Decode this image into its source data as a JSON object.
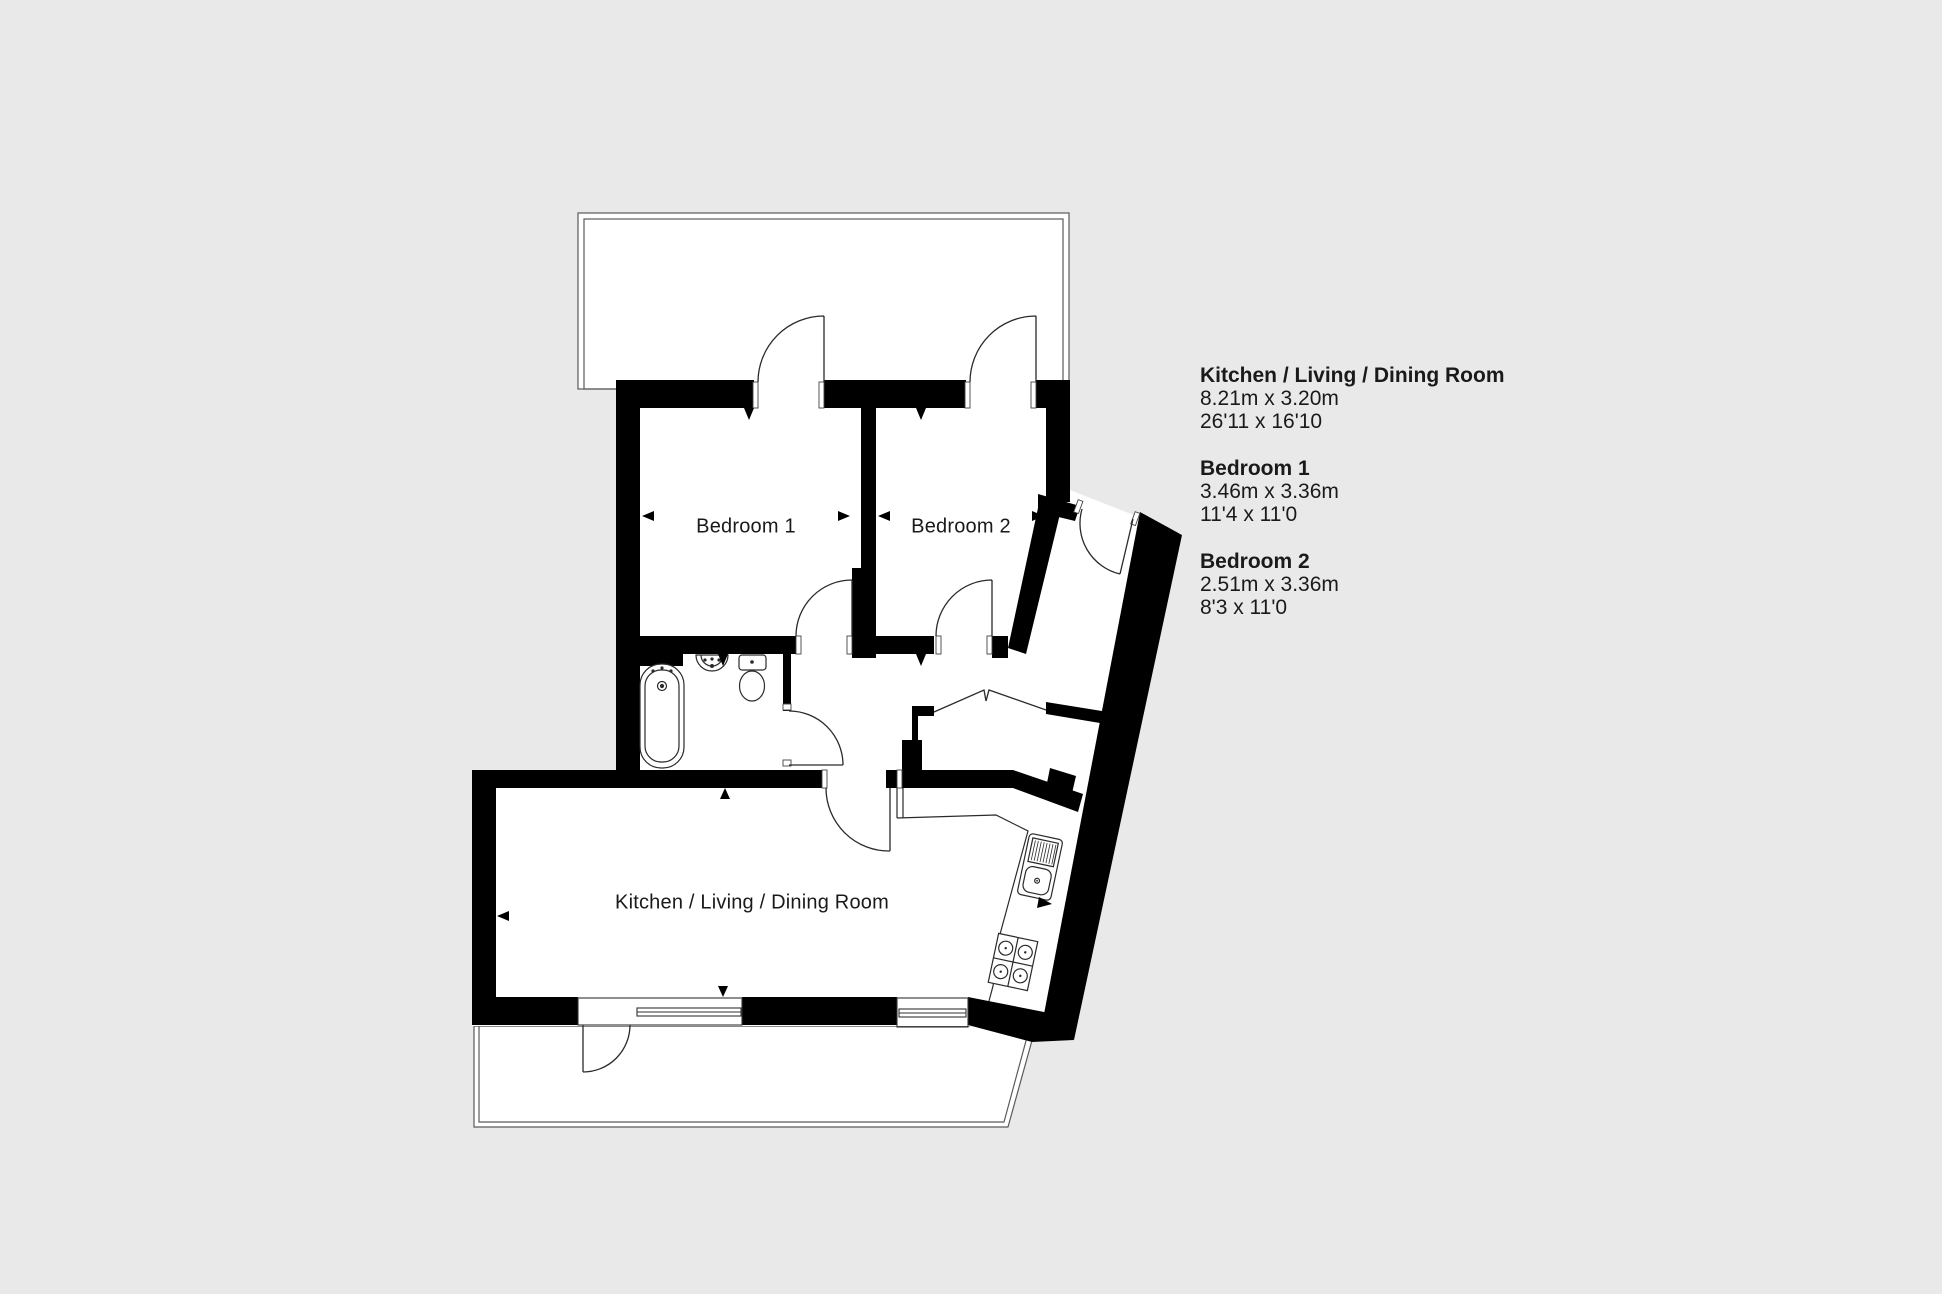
{
  "floorplan": {
    "background_color": "#e9e9e9",
    "wall_color": "#000000",
    "floor_color": "#ffffff",
    "rooms": [
      {
        "label": "Bedroom 1"
      },
      {
        "label": "Bedroom 2"
      },
      {
        "label": "Kitchen / Living / Dining Room"
      }
    ],
    "legend": [
      {
        "name": "Kitchen / Living / Dining Room",
        "metric_size": "8.21m x 3.20m",
        "imperial_size": "26'11 x 16'10"
      },
      {
        "name": "Bedroom 1",
        "metric_size": "3.46m x 3.36m",
        "imperial_size": "11'4 x 11'0"
      },
      {
        "name": "Bedroom 2",
        "metric_size": "2.51m x 3.36m",
        "imperial_size": "8'3 x 11'0"
      }
    ]
  }
}
